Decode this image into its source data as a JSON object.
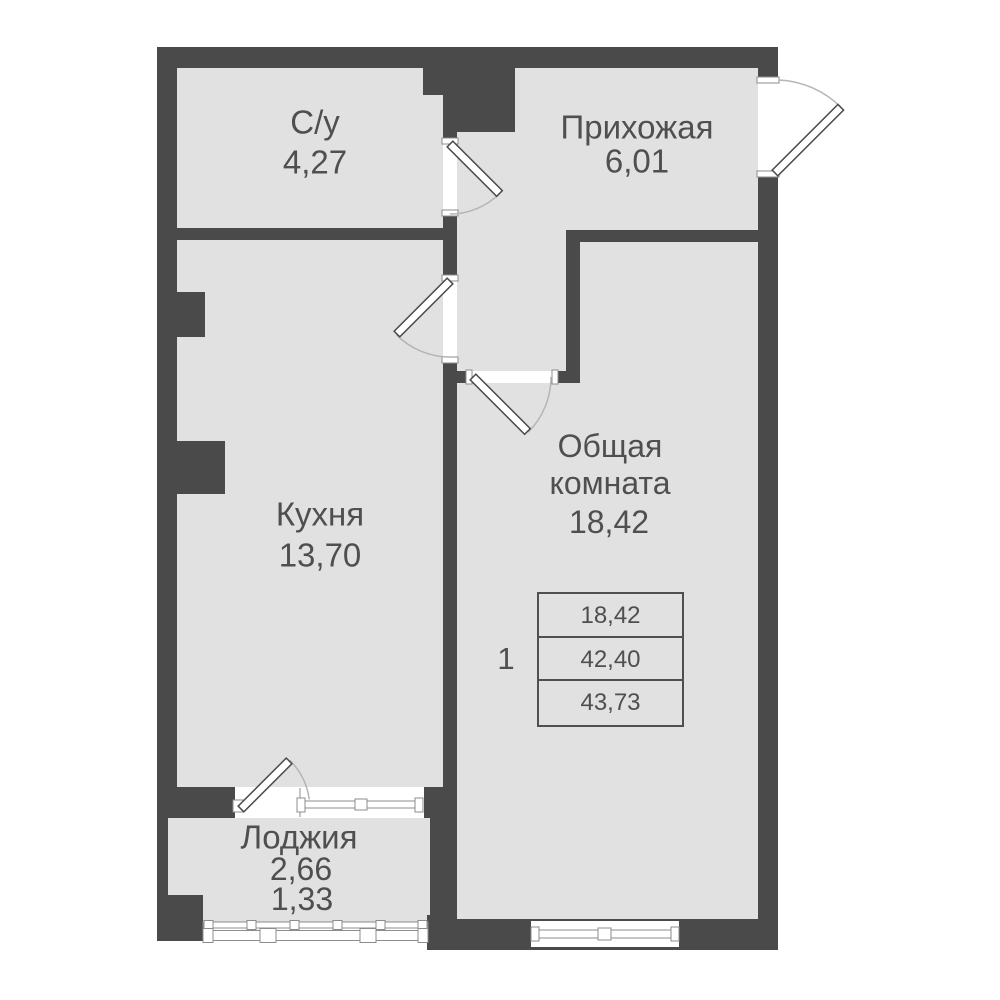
{
  "rooms": {
    "bathroom": {
      "label": "С/у",
      "area": "4,27"
    },
    "hallway": {
      "label": "Прихожая",
      "area": "6,01"
    },
    "kitchen": {
      "label": "Кухня",
      "area": "13,70"
    },
    "living": {
      "label_line1": "Общая",
      "label_line2": "комната",
      "area": "18,42"
    },
    "loggia": {
      "label": "Лоджия",
      "area_full": "2,66",
      "area_reduced": "1,33"
    }
  },
  "summary": {
    "unit_number": "1",
    "values": [
      "18,42",
      "42,40",
      "43,73"
    ]
  },
  "colors": {
    "wall": "#4a4a4a",
    "floor": "#e1e1e1",
    "text": "#4f4f4f",
    "outline": "#8c8c8c",
    "arc": "#b5b5b5"
  }
}
